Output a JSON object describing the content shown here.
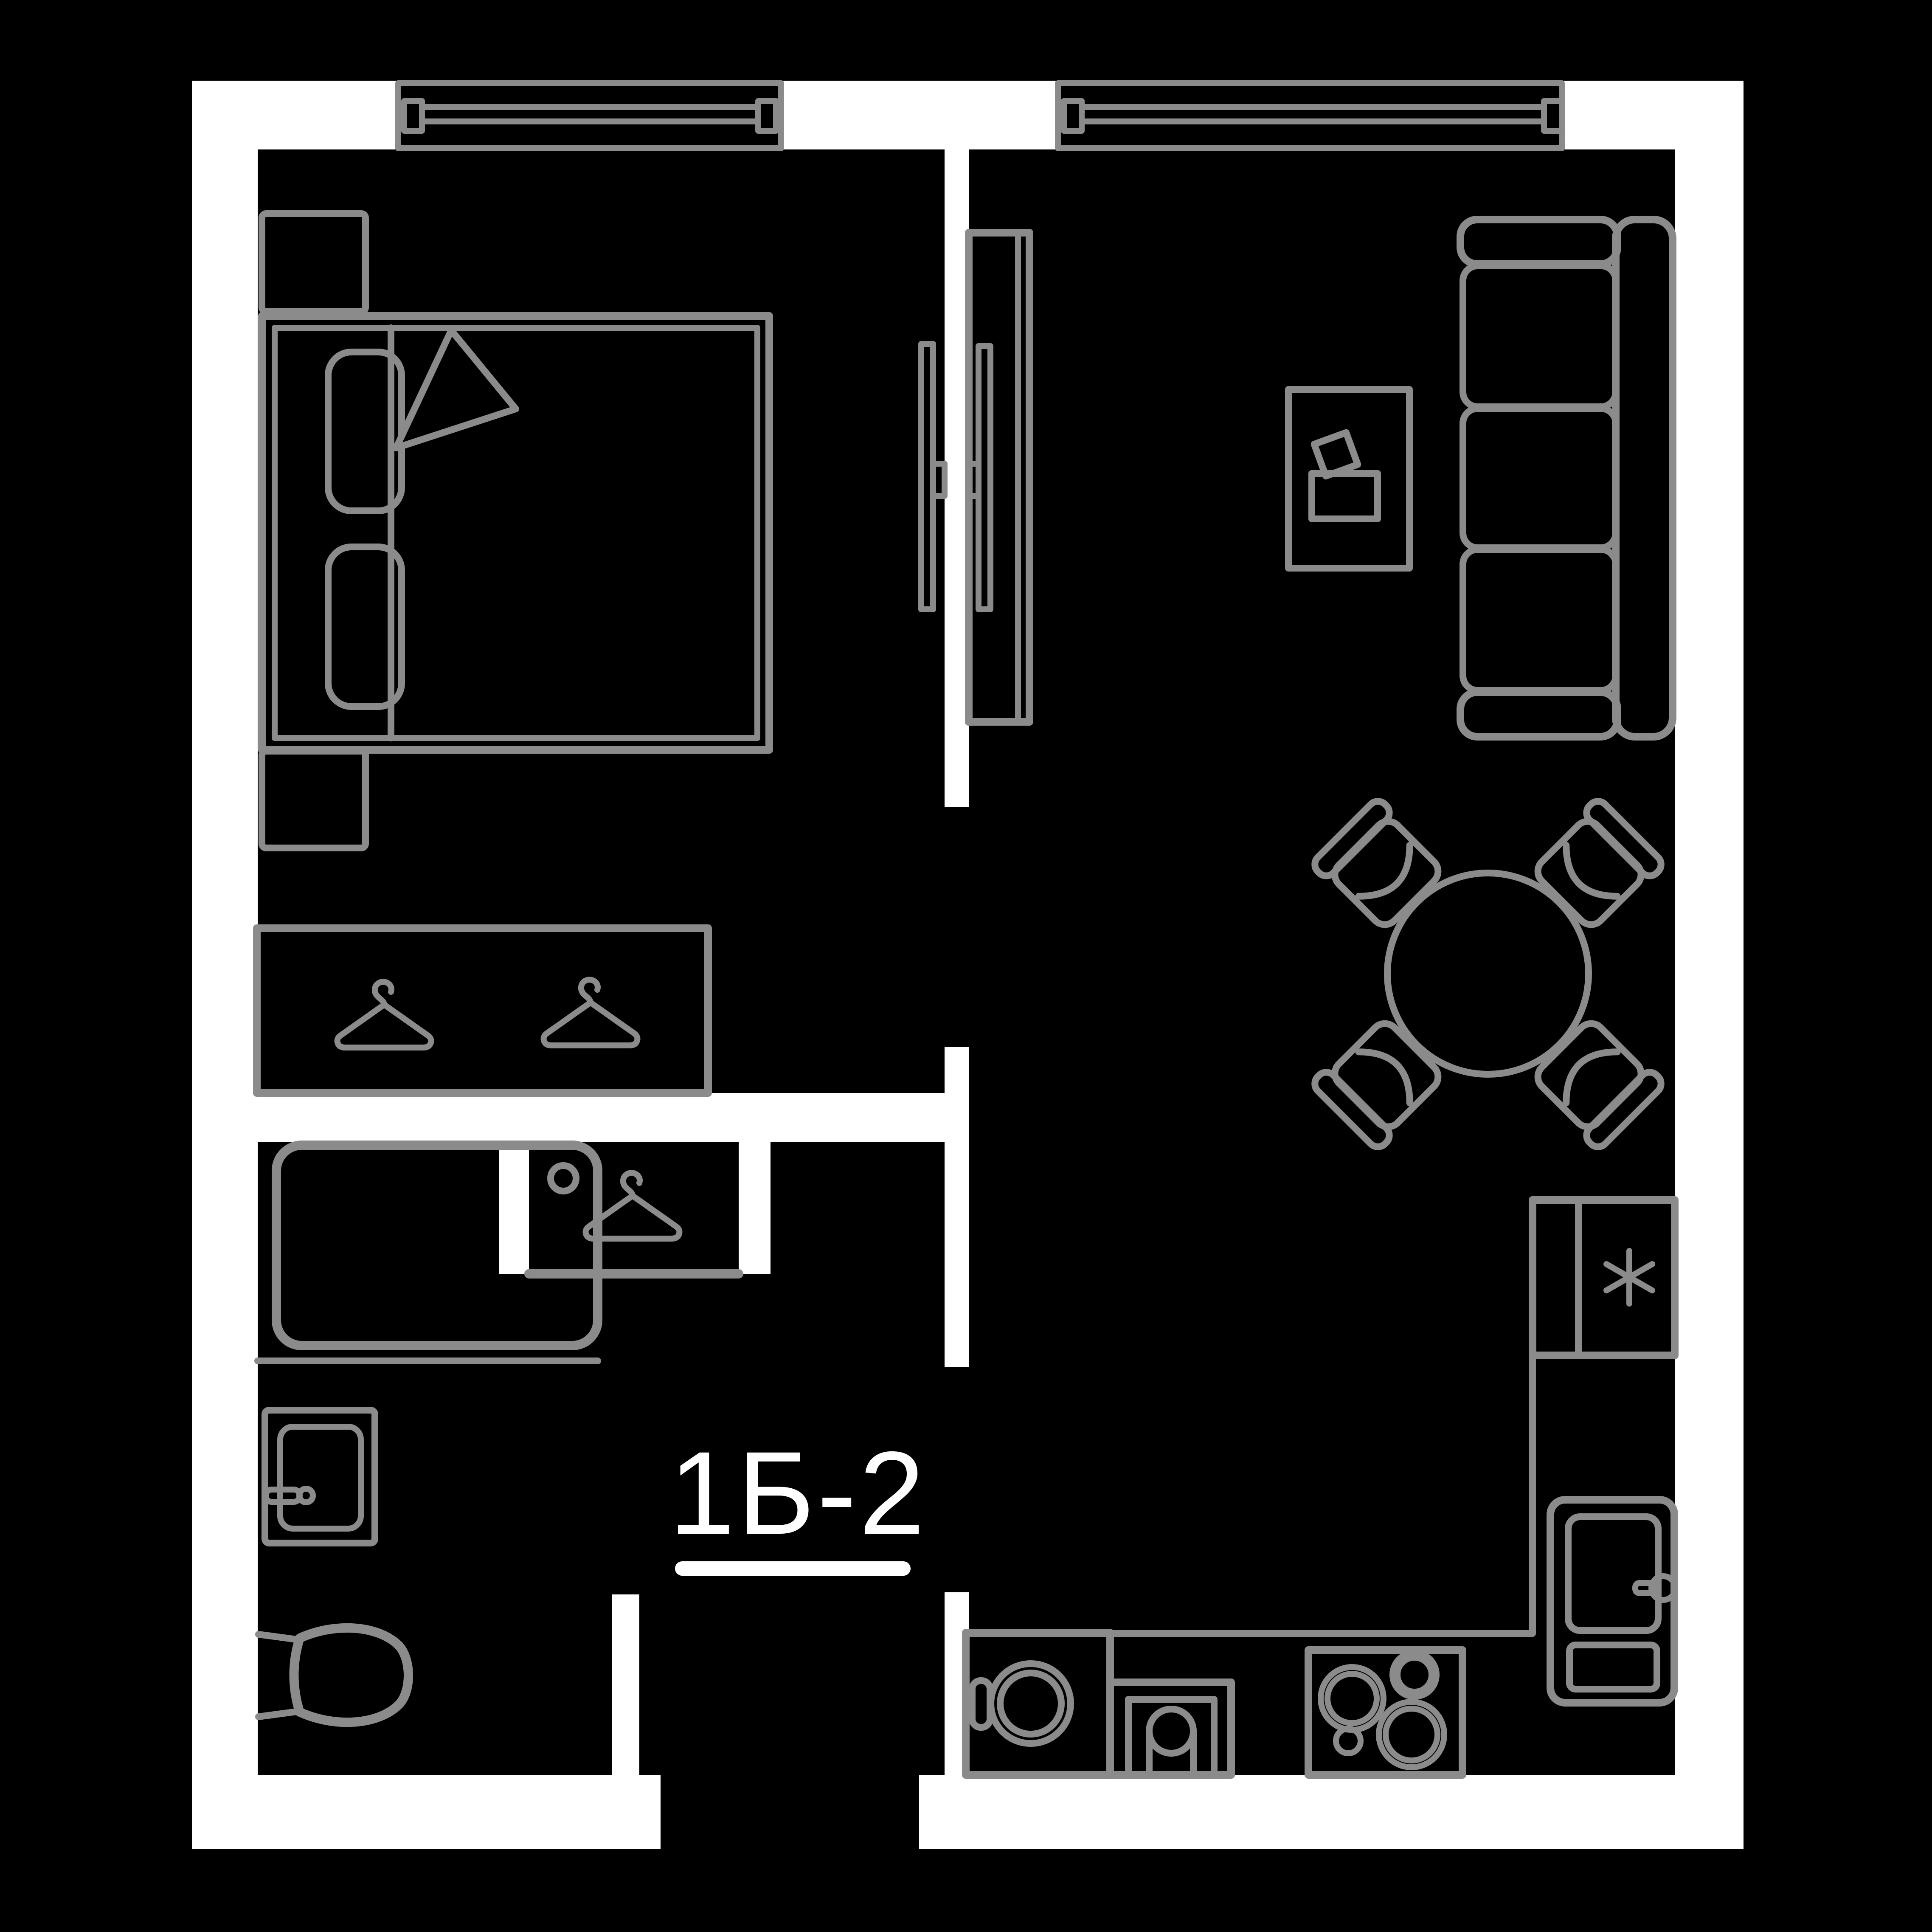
{
  "unit_label": {
    "text": "1Б-2"
  },
  "colors": {
    "background": "#000000",
    "walls": "#ffffff",
    "lines": "#8b8b8b",
    "label_text": "#ffffff"
  },
  "plan": {
    "type": "apartment-floor-plan",
    "windows_count": 2,
    "rooms": [
      "bedroom",
      "living-room-with-kitchen",
      "hallway",
      "bathroom",
      "closet-niche"
    ],
    "icons": [
      "window-icon",
      "double-bed-icon",
      "pillow-icon",
      "blanket-fold-icon",
      "nightstand-icon",
      "wardrobe-icon",
      "clothes-hanger-icon",
      "tv-icon",
      "tv-cabinet-icon",
      "sofa-icon",
      "coffee-table-icon",
      "round-dining-table-icon",
      "chair-icon",
      "kitchen-counter-icon",
      "fridge-freezer-icon",
      "snowflake-asterisk-icon",
      "kitchen-sink-icon",
      "washing-machine-icon",
      "oven-icon",
      "cooktop-icon",
      "shower-tray-icon",
      "washbasin-icon",
      "toilet-icon"
    ]
  }
}
